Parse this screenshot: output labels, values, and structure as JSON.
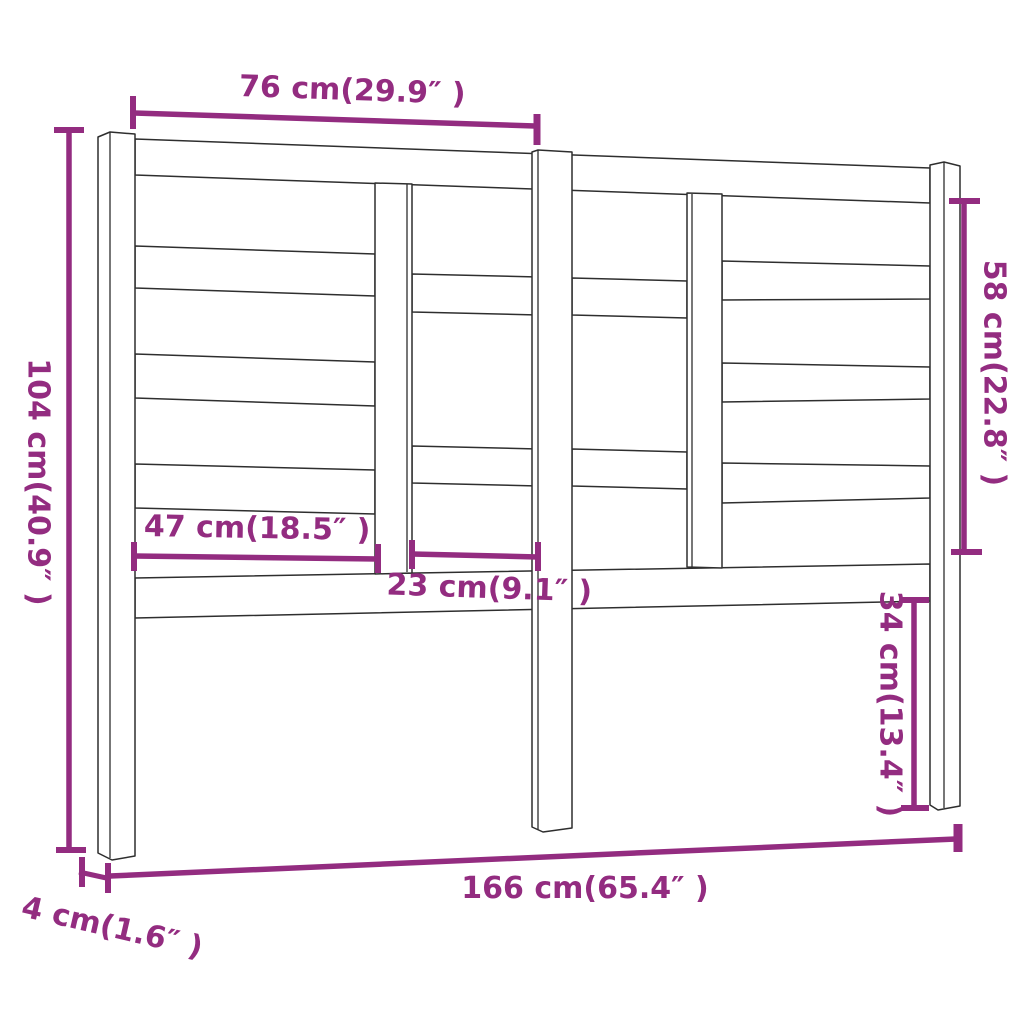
{
  "diagram": {
    "title": "bed-headboard-dimension-diagram",
    "background_color": "#ffffff",
    "accent_color": "#932c80",
    "outline_color": "#2e2e2e",
    "dimensions": {
      "top_width": {
        "label": "76 cm(29.9″ )",
        "value_cm": 76,
        "value_in": 29.9
      },
      "total_height": {
        "label": "104 cm(40.9″ )",
        "value_cm": 104,
        "value_in": 40.9
      },
      "slat_panel_height": {
        "label": "58 cm(22.8″ )",
        "value_cm": 58,
        "value_in": 22.8
      },
      "left_opening_width": {
        "label": "47 cm(18.5″ )",
        "value_cm": 47,
        "value_in": 18.5
      },
      "center_opening_width": {
        "label": "23 cm(9.1″ )",
        "value_cm": 23,
        "value_in": 9.1
      },
      "leg_height": {
        "label": "34 cm(13.4″ )",
        "value_cm": 34,
        "value_in": 13.4
      },
      "total_width": {
        "label": "166 cm(65.4″ )",
        "value_cm": 166,
        "value_in": 65.4
      },
      "depth": {
        "label": "4 cm(1.6″ )",
        "value_cm": 4,
        "value_in": 1.6
      }
    }
  }
}
